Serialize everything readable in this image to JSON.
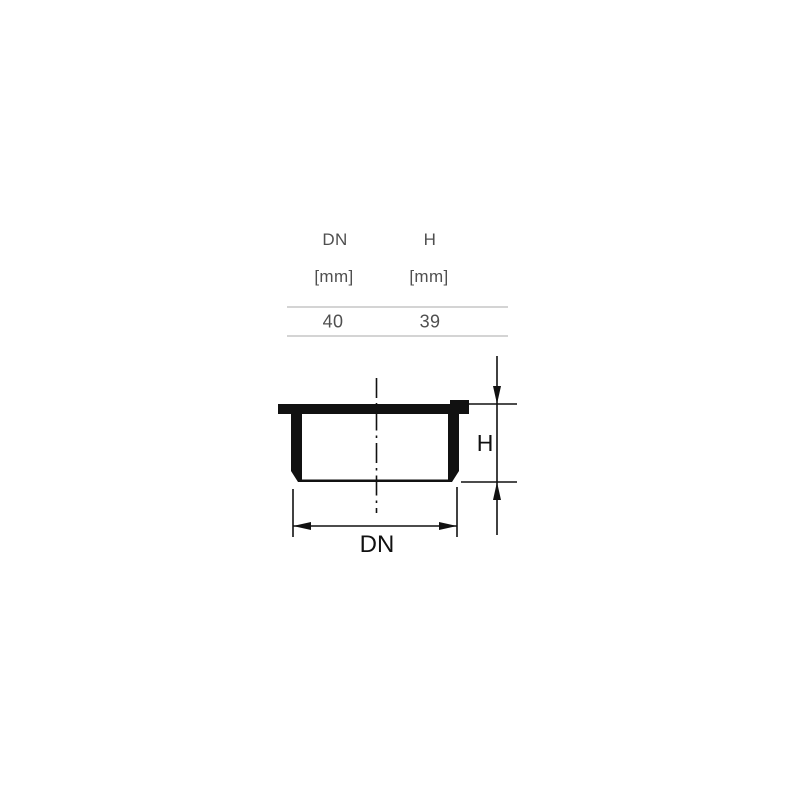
{
  "table": {
    "columns": [
      {
        "name": "DN",
        "unit": "[mm]",
        "value": "40"
      },
      {
        "name": "H",
        "unit": "[mm]",
        "value": "39"
      }
    ]
  },
  "drawing": {
    "h_label": "H",
    "dn_label": "DN"
  },
  "colors": {
    "background": "#ffffff",
    "table_text": "#4f4f4f",
    "table_line": "#d4d4d4",
    "drawing_ink": "#111111"
  }
}
